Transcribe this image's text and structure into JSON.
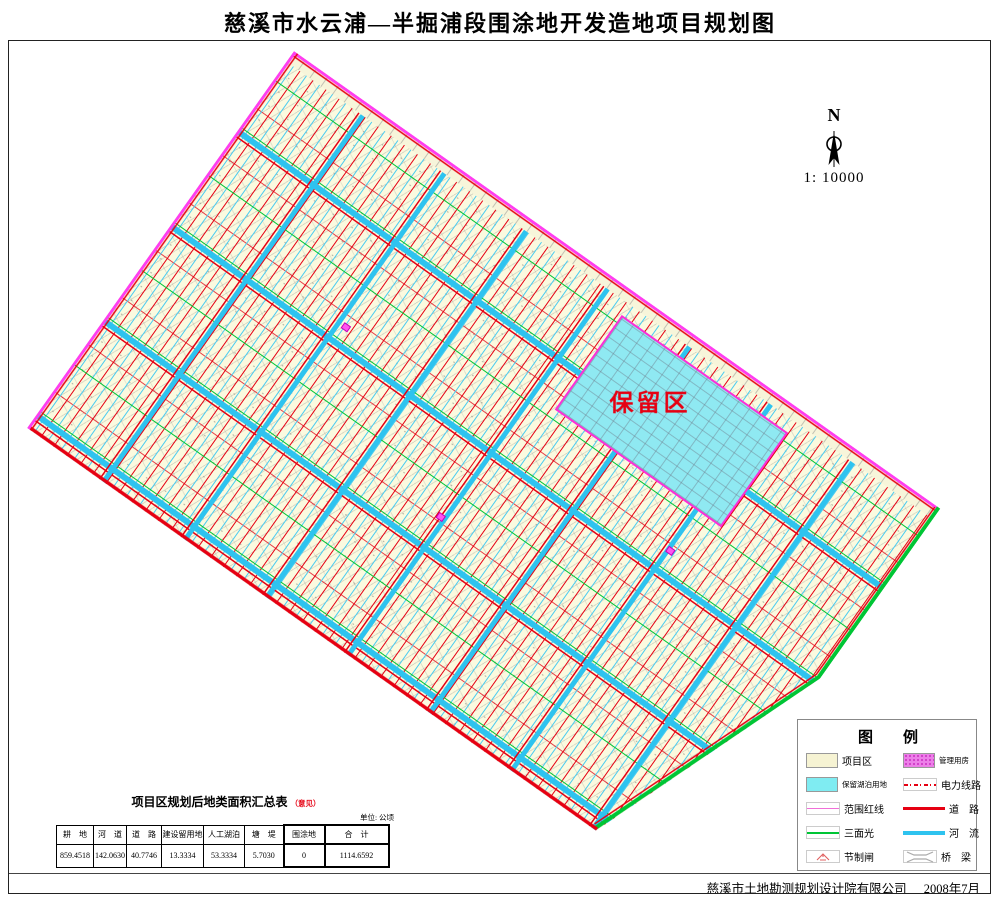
{
  "title": "慈溪市水云浦—半掘浦段围涂地开发造地项目规划图",
  "north": {
    "label": "N",
    "scale": "1: 10000"
  },
  "map": {
    "reserved_area_label": "保留区"
  },
  "legend": {
    "title": "图　　例",
    "items": [
      {
        "label": "项目区"
      },
      {
        "label": "管理用房"
      },
      {
        "label": "保留湖泊用地"
      },
      {
        "label": "电力线路"
      },
      {
        "label": "范围红线"
      },
      {
        "label": "道　路"
      },
      {
        "label": "三面光"
      },
      {
        "label": "河　流"
      },
      {
        "label": "节制闸"
      },
      {
        "label": "桥　梁"
      }
    ]
  },
  "table": {
    "title": "项目区规划后地类面积汇总表",
    "note": "（意见）",
    "unit": "单位: 公顷",
    "headers": [
      "耕　地",
      "河　道",
      "道　路",
      "建设留用地",
      "人工湖泊",
      "塘　堤",
      "围涂地",
      "合　计"
    ],
    "values": [
      "859.4518",
      "142.0630",
      "40.7746",
      "13.3334",
      "53.3334",
      "5.7030",
      "0",
      "1114.6592"
    ]
  },
  "footer": {
    "company": "慈溪市土地勘测规划设计院有限公司",
    "date": "2008年7月"
  },
  "colors": {
    "road_red": "#E60012",
    "river_cyan": "#2EC3EF",
    "boundary_magenta": "#FF3DF0",
    "canal_green": "#00C535",
    "parcel_cream": "#FBFADF",
    "reserved_cyan": "#8FE9F2",
    "management_pink": "#EC7FE8"
  }
}
